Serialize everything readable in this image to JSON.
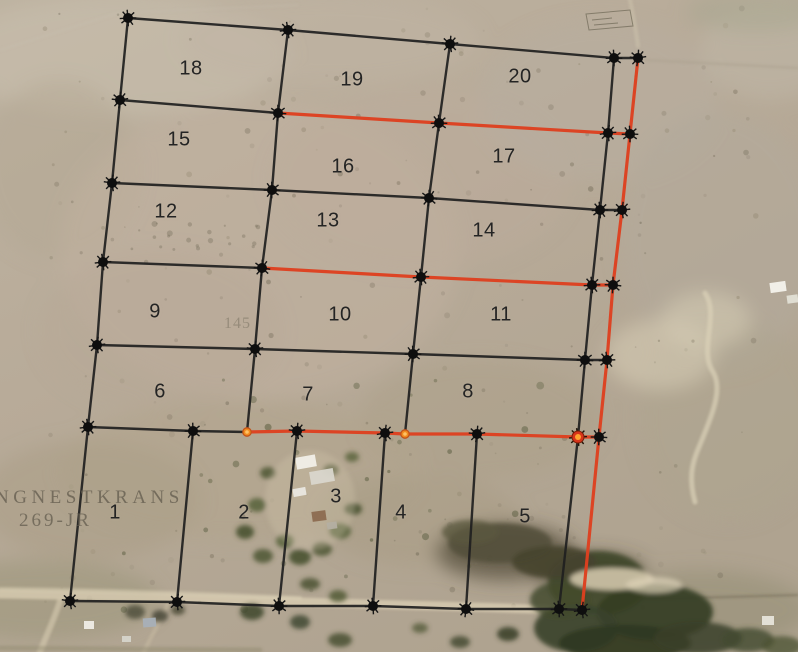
{
  "map": {
    "farm_label": {
      "line1": "NGNESTKRANS",
      "line2": "269-JR"
    },
    "faint_label": "145",
    "colors": {
      "boundary": "#1f1f1f",
      "highlight": "#de3f1f",
      "orange_node_core": "#ffa22e",
      "orange_node_ring": "#c2521a"
    },
    "parcel_labels": [
      {
        "n": "18",
        "x": 191,
        "y": 69
      },
      {
        "n": "19",
        "x": 352,
        "y": 80
      },
      {
        "n": "20",
        "x": 520,
        "y": 77
      },
      {
        "n": "15",
        "x": 179,
        "y": 140
      },
      {
        "n": "16",
        "x": 343,
        "y": 167
      },
      {
        "n": "17",
        "x": 504,
        "y": 157
      },
      {
        "n": "12",
        "x": 166,
        "y": 212
      },
      {
        "n": "13",
        "x": 328,
        "y": 221
      },
      {
        "n": "14",
        "x": 484,
        "y": 231
      },
      {
        "n": "9",
        "x": 155,
        "y": 312
      },
      {
        "n": "10",
        "x": 340,
        "y": 315
      },
      {
        "n": "11",
        "x": 501,
        "y": 315
      },
      {
        "n": "6",
        "x": 160,
        "y": 392
      },
      {
        "n": "7",
        "x": 308,
        "y": 395
      },
      {
        "n": "8",
        "x": 468,
        "y": 392
      },
      {
        "n": "1",
        "x": 115,
        "y": 513
      },
      {
        "n": "2",
        "x": 244,
        "y": 513
      },
      {
        "n": "3",
        "x": 336,
        "y": 497
      },
      {
        "n": "4",
        "x": 401,
        "y": 513
      },
      {
        "n": "5",
        "x": 525,
        "y": 517
      }
    ],
    "edges": [
      {
        "type": "boundary",
        "pts": [
          [
            128,
            18
          ],
          [
            288,
            30
          ],
          [
            450,
            44
          ],
          [
            614,
            58
          ],
          [
            638,
            58
          ]
        ]
      },
      {
        "type": "boundary",
        "pts": [
          [
            120,
            100
          ],
          [
            278,
            113
          ]
        ]
      },
      {
        "type": "boundary",
        "pts": [
          [
            112,
            183
          ],
          [
            272,
            190
          ],
          [
            429,
            198
          ],
          [
            600,
            210
          ],
          [
            622,
            210
          ]
        ]
      },
      {
        "type": "boundary",
        "pts": [
          [
            103,
            262
          ],
          [
            262,
            268
          ]
        ]
      },
      {
        "type": "boundary",
        "pts": [
          [
            97,
            345
          ],
          [
            255,
            349
          ],
          [
            413,
            354
          ],
          [
            585,
            360
          ],
          [
            607,
            360
          ]
        ]
      },
      {
        "type": "boundary",
        "pts": [
          [
            88,
            427
          ],
          [
            193,
            431
          ],
          [
            247,
            432
          ]
        ]
      },
      {
        "type": "boundary",
        "pts": [
          [
            70,
            601
          ],
          [
            177,
            602
          ],
          [
            279,
            606
          ],
          [
            373,
            606
          ],
          [
            466,
            609
          ],
          [
            559,
            609
          ],
          [
            582,
            610
          ]
        ]
      },
      {
        "type": "boundary",
        "pts": [
          [
            128,
            18
          ],
          [
            120,
            100
          ],
          [
            112,
            183
          ],
          [
            103,
            262
          ],
          [
            97,
            345
          ],
          [
            88,
            427
          ],
          [
            70,
            601
          ]
        ]
      },
      {
        "type": "boundary",
        "pts": [
          [
            193,
            431
          ],
          [
            177,
            602
          ]
        ]
      },
      {
        "type": "boundary",
        "pts": [
          [
            288,
            30
          ],
          [
            278,
            113
          ],
          [
            272,
            190
          ],
          [
            262,
            268
          ],
          [
            255,
            349
          ],
          [
            247,
            432
          ]
        ]
      },
      {
        "type": "boundary",
        "pts": [
          [
            297,
            431
          ],
          [
            279,
            606
          ]
        ]
      },
      {
        "type": "boundary",
        "pts": [
          [
            450,
            44
          ],
          [
            439,
            123
          ],
          [
            429,
            198
          ],
          [
            421,
            277
          ],
          [
            413,
            354
          ],
          [
            405,
            434
          ]
        ]
      },
      {
        "type": "boundary",
        "pts": [
          [
            385,
            433
          ],
          [
            373,
            606
          ]
        ]
      },
      {
        "type": "boundary",
        "pts": [
          [
            614,
            58
          ],
          [
            608,
            133
          ],
          [
            600,
            210
          ],
          [
            592,
            285
          ],
          [
            585,
            360
          ],
          [
            578,
            437
          ],
          [
            559,
            609
          ]
        ]
      },
      {
        "type": "boundary",
        "pts": [
          [
            477,
            434
          ],
          [
            466,
            609
          ]
        ]
      },
      {
        "type": "highlight",
        "pts": [
          [
            278,
            113
          ],
          [
            439,
            123
          ],
          [
            608,
            133
          ],
          [
            630,
            134
          ]
        ]
      },
      {
        "type": "highlight",
        "pts": [
          [
            262,
            268
          ],
          [
            421,
            277
          ],
          [
            592,
            285
          ],
          [
            613,
            285
          ]
        ]
      },
      {
        "type": "highlight",
        "pts": [
          [
            247,
            432
          ],
          [
            297,
            431
          ],
          [
            385,
            433
          ],
          [
            405,
            434
          ],
          [
            477,
            434
          ],
          [
            578,
            437
          ],
          [
            599,
            437
          ]
        ]
      },
      {
        "type": "highlight",
        "pts": [
          [
            638,
            58
          ],
          [
            630,
            134
          ],
          [
            622,
            210
          ],
          [
            613,
            285
          ],
          [
            607,
            360
          ],
          [
            599,
            437
          ],
          [
            582,
            610
          ]
        ]
      }
    ],
    "nodes": [
      [
        128,
        18
      ],
      [
        288,
        30
      ],
      [
        450,
        44
      ],
      [
        614,
        58
      ],
      [
        638,
        58
      ],
      [
        120,
        100
      ],
      [
        278,
        113
      ],
      [
        439,
        123
      ],
      [
        608,
        133
      ],
      [
        630,
        134
      ],
      [
        112,
        183
      ],
      [
        272,
        190
      ],
      [
        429,
        198
      ],
      [
        600,
        210
      ],
      [
        622,
        210
      ],
      [
        103,
        262
      ],
      [
        262,
        268
      ],
      [
        421,
        277
      ],
      [
        592,
        285
      ],
      [
        613,
        285
      ],
      [
        97,
        345
      ],
      [
        255,
        349
      ],
      [
        413,
        354
      ],
      [
        585,
        360
      ],
      [
        607,
        360
      ],
      [
        88,
        427
      ],
      [
        193,
        431
      ],
      [
        297,
        431
      ],
      [
        385,
        433
      ],
      [
        477,
        434
      ],
      [
        599,
        437
      ],
      [
        70,
        601
      ],
      [
        177,
        602
      ],
      [
        279,
        606
      ],
      [
        373,
        606
      ],
      [
        466,
        609
      ],
      [
        559,
        609
      ],
      [
        582,
        610
      ]
    ],
    "orange_nodes": [
      {
        "x": 247,
        "y": 432,
        "size": "small"
      },
      {
        "x": 405,
        "y": 434,
        "size": "small"
      },
      {
        "x": 578,
        "y": 437,
        "size": "large"
      }
    ]
  }
}
